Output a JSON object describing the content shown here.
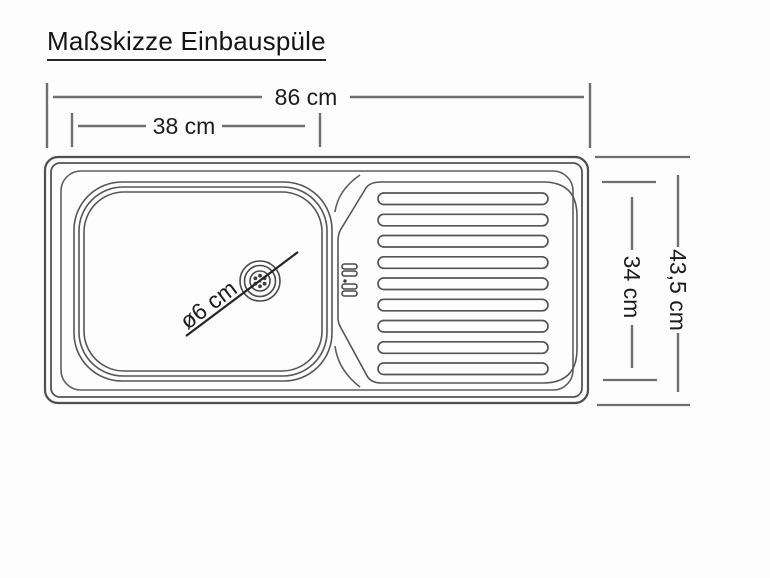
{
  "title": "Maßskizze Einbauspüle",
  "colors": {
    "background": "#fdfdfd",
    "drawing_line": "#555555",
    "dimension_line": "#6f6f6f",
    "text": "#1c1c1c"
  },
  "dimensions": {
    "overall_width": "86 cm",
    "basin_width": "38 cm",
    "overall_depth": "43,5 cm",
    "drainer_depth": "34 cm",
    "drain_diameter": "ø6 cm"
  },
  "drawing": {
    "ribs_count": 9
  }
}
